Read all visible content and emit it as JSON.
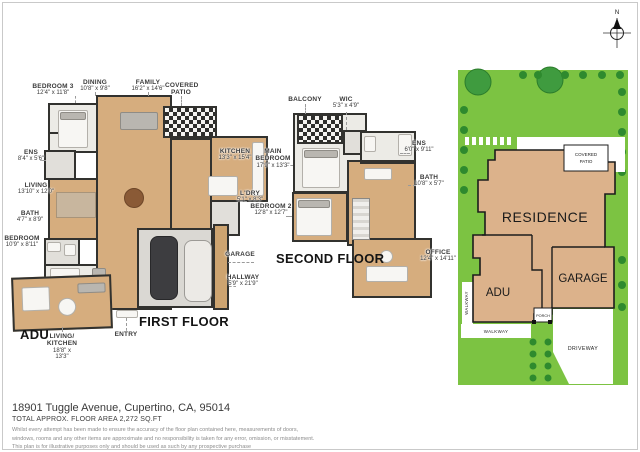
{
  "sheet": {
    "first_floor_title": "FIRST FLOOR",
    "second_floor_title": "SECOND FLOOR",
    "adu_title": "ADU"
  },
  "first_floor": {
    "rooms": [
      {
        "name": "BEDROOM 3",
        "dims": "12'4\" x 11'8\""
      },
      {
        "name": "DINING",
        "dims": "10'8\" x 9'8\""
      },
      {
        "name": "FAMILY",
        "dims": "16'2\" x 14'6\""
      },
      {
        "name": "COVERED PATIO",
        "dims": ""
      },
      {
        "name": "ENS",
        "dims": "8'4\" x 5'6\""
      },
      {
        "name": "KITCHEN",
        "dims": "13'3\" x 15'4\""
      },
      {
        "name": "LIVING",
        "dims": "13'10\" x 12'0\""
      },
      {
        "name": "BATH",
        "dims": "4'7\" x 8'9\""
      },
      {
        "name": "BEDROOM",
        "dims": "10'9\" x 8'11\""
      },
      {
        "name": "L'DRY",
        "dims": "5'1\" x 8'3\""
      },
      {
        "name": "GARAGE",
        "dims": ""
      },
      {
        "name": "HALLWAY",
        "dims": "5'9\" x 21'9\""
      },
      {
        "name": "LIVING/ KITCHEN",
        "dims": "18'8\" x 13'3\""
      },
      {
        "name": "ENTRY",
        "dims": ""
      }
    ]
  },
  "second_floor": {
    "rooms": [
      {
        "name": "BALCONY",
        "dims": ""
      },
      {
        "name": "WIC",
        "dims": "5'3\" x 4'9\""
      },
      {
        "name": "MAIN BEDROOM",
        "dims": "17'9\" x 13'3\""
      },
      {
        "name": "ENS",
        "dims": "6'0\" x 9'11\""
      },
      {
        "name": "BATH",
        "dims": "10'8\" x 5'7\""
      },
      {
        "name": "BEDROOM 2",
        "dims": "12'8\" x 12'7\""
      },
      {
        "name": "OFFICE",
        "dims": "12'4\" x 14'11\""
      }
    ]
  },
  "site_plan": {
    "compass": "N",
    "residence": "RESIDENCE",
    "garage": "GARAGE",
    "adu": "ADU",
    "covered_patio_line1": "COVERED",
    "covered_patio_line2": "PATIO",
    "walkway_left": "WALKWAY",
    "walkway_bottom": "WALKWAY",
    "porch": "PORCH",
    "driveway": "DRIVEWAY",
    "colors": {
      "lawn": "#7cc342",
      "tree": "#3f9b3f",
      "bush": "#2e8a2e",
      "building": "#dcb28b",
      "paving": "#ffffff"
    }
  },
  "footer": {
    "address": "18901 Tuggle Avenue, Cupertino, CA, 95014",
    "area_line": "TOTAL APPROX. FLOOR AREA 2,272 SQ.FT",
    "disclaimer_lines": [
      "Whilst every attempt has been made to ensure the accuracy of the floor plan contained here, measurements of doors,",
      "windows, rooms and any other items are approximate and no responsibility is taken for any error, omission, or misstatement.",
      "This plan is for illustrative purposes only and should be used as such by any prospective purchase"
    ]
  }
}
